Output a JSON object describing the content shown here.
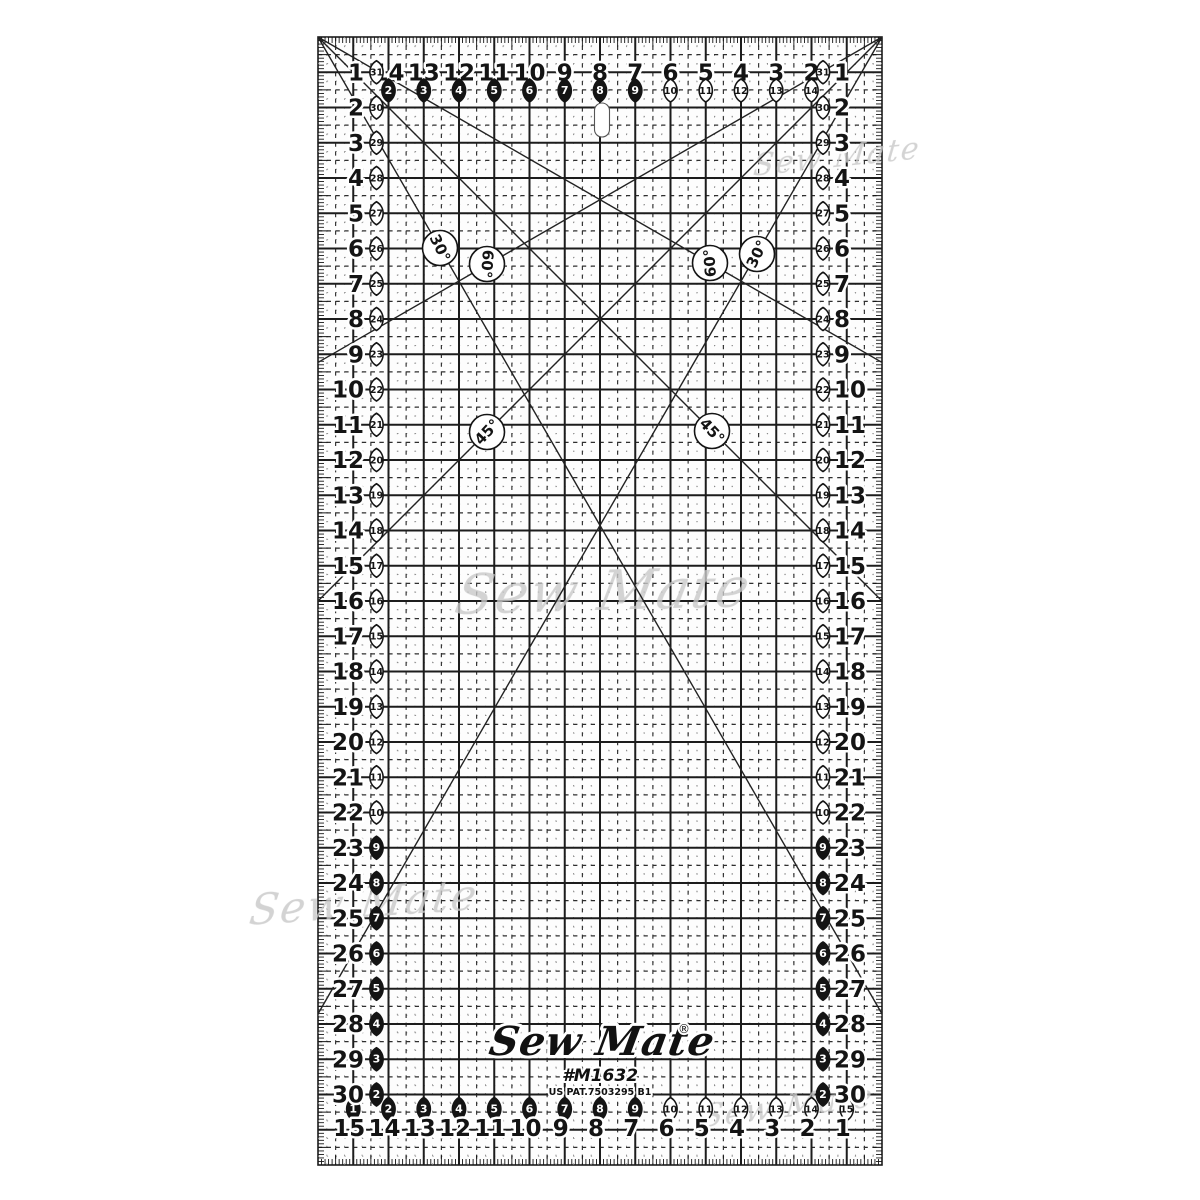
{
  "product": {
    "brand": "Sew Mate",
    "registered_mark": "®",
    "model": "#M1632",
    "patent": "US PAT.7503295 B1"
  },
  "watermark": {
    "text": "Sew Mate"
  },
  "angle_labels": {
    "left_30": "30°",
    "left_60": "60°",
    "right_60": "60°",
    "right_30": "30°",
    "left_45": "45°",
    "right_45": "45°"
  },
  "scales": {
    "top": {
      "numbers": [
        14,
        13,
        12,
        11,
        10,
        9,
        8,
        7,
        6,
        5,
        4,
        3,
        2
      ],
      "badges": [
        2,
        3,
        4,
        5,
        6,
        7,
        8,
        9,
        10,
        11,
        12,
        13,
        14
      ]
    },
    "bottom": {
      "badges": [
        1,
        2,
        3,
        4,
        5,
        6,
        7,
        8,
        9,
        10,
        11,
        12,
        13,
        14,
        15
      ],
      "numbers": [
        15,
        14,
        13,
        12,
        11,
        10,
        9,
        8,
        7,
        6,
        5,
        4,
        3,
        2,
        1
      ]
    },
    "left": {
      "numbers": [
        1,
        2,
        3,
        4,
        5,
        6,
        7,
        8,
        9,
        10,
        11,
        12,
        13,
        14,
        15,
        16,
        17,
        18,
        19,
        20,
        21,
        22,
        23,
        24,
        25,
        26,
        27,
        28,
        29,
        30
      ],
      "badges": [
        31,
        30,
        29,
        28,
        27,
        26,
        25,
        24,
        23,
        22,
        21,
        20,
        19,
        18,
        17,
        16,
        15,
        14,
        13,
        12,
        11,
        10,
        9,
        8,
        7,
        6,
        5,
        4,
        3,
        2
      ]
    },
    "right": {
      "badges": [
        31,
        30,
        29,
        28,
        27,
        26,
        25,
        24,
        23,
        22,
        21,
        20,
        19,
        18,
        17,
        16,
        15,
        14,
        13,
        12,
        11,
        10,
        9,
        8,
        7,
        6,
        5,
        4,
        3,
        2
      ],
      "numbers": [
        1,
        2,
        3,
        4,
        5,
        6,
        7,
        8,
        9,
        10,
        11,
        12,
        13,
        14,
        15,
        16,
        17,
        18,
        19,
        20,
        21,
        22,
        23,
        24,
        25,
        26,
        27,
        28,
        29,
        30
      ]
    }
  },
  "colors": {
    "ink": "#141414",
    "grid_major": "#1c1c1c",
    "grid_dashed": "#2e2e2e",
    "grid_dotted": "#8a8a8a",
    "diagonal": "#222222",
    "ruler_body": "#fdfdfd",
    "background": "#ffffff",
    "watermark": "#c9c9c9",
    "badge_dark_fill": "#141414",
    "badge_light_text": "#ffffff"
  }
}
